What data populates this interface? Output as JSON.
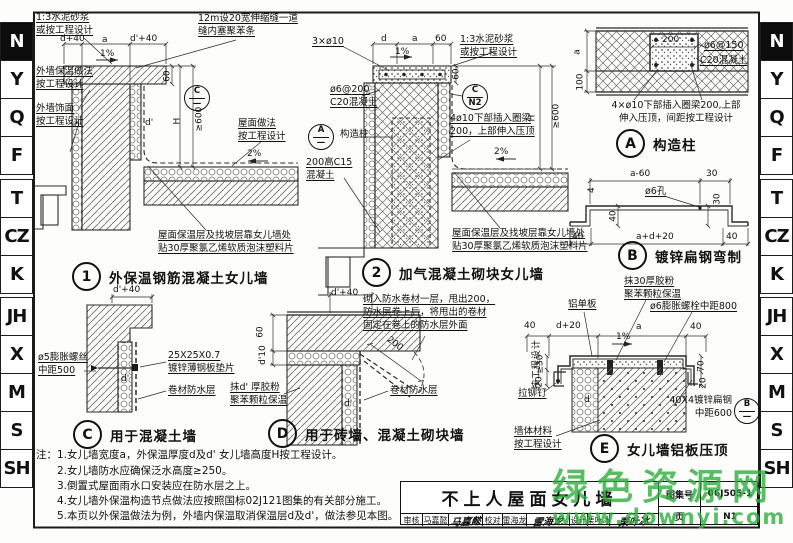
{
  "sidebar": {
    "tabs": [
      "N",
      "Y",
      "Q",
      "F",
      "T",
      "CZ",
      "K",
      "JH",
      "X",
      "M",
      "S",
      "SH"
    ]
  },
  "details": {
    "d1": {
      "num": "1",
      "caption": "外保温钢筋混凝土女儿墙",
      "ref_top": "C",
      "ref_bottom": "—",
      "mortar": "1:3水泥砂浆\n或按工程设计",
      "joint": "12m设20宽伸缩缝一道\n缝内塞聚苯条",
      "wall_insul": "外墙保温做法\n按工程设计",
      "wall_finish": "外墙饰面\n按工程设计",
      "roof": "屋面做法\n按工程设计",
      "foam": "屋面保温层及找坡层靠女儿墙处\n贴30厚聚氯乙烯软质泡沫塑料片",
      "dims": {
        "top_l": "d+40",
        "top_m": "a",
        "top_r": "d'+40",
        "coping_h": "60",
        "h": "H",
        "min_h": "≥600",
        "d": "d",
        "d2": "d'",
        "slope_top": "1%",
        "slope_roof": "2%"
      }
    },
    "d2": {
      "num": "2",
      "caption": "加气混凝土砌块女儿墙",
      "ref_top": "C",
      "ref_bottom": "N2",
      "col_ref_top": "A",
      "col_ref_bottom": "—",
      "rebar": "3×ø10",
      "mesh": "ø6@200\nC20混凝土",
      "col_label": "构造柱",
      "c15": "200高C15\n混凝土",
      "mortar": "1:3水泥砂浆\n或按工程设计",
      "anchor": "4ø10下部插入圈梁\n200，上部伸入压顶",
      "foam": "屋面保温层及找坡层靠女儿墙处\n贴30厚聚氯乙烯软质泡沫塑料片",
      "dims": {
        "top_l": "d",
        "top_m": "a",
        "top_r": "60",
        "coping_h": "60",
        "h": "H",
        "min_h": "≥600",
        "slope_top": "1%",
        "slope_roof": "2%"
      }
    },
    "da": {
      "letter": "A",
      "caption": "构造柱",
      "mesh": "ø6@150",
      "conc": "C20混凝土",
      "note": "4×ø10下部插入圈梁200,上部\n伸入压顶，间距按工程设计",
      "dims": {
        "w": "200",
        "a": "a",
        "h": "100"
      }
    },
    "db": {
      "letter": "B",
      "caption": "镀锌扁钢弯制",
      "hole": "ø6孔",
      "dims": {
        "top_l": "a-60",
        "top_r": "30",
        "bot_l": "40",
        "bot_m": "a+d+20",
        "bot_r": "40",
        "v_l": "40",
        "v_r": "30",
        "t": "4"
      }
    },
    "dc": {
      "letter": "C",
      "caption": "用于混凝土墙",
      "bolt": "ø5膨胀螺丝\n中距500",
      "shim": "25X25X0.7\n镀锌薄钢板垫片",
      "membrane": "卷材防水层",
      "dims": {
        "top": "d'+40",
        "d": "d'"
      }
    },
    "dd": {
      "letter": "D",
      "caption": "用于砖墙、混凝土砌块墙",
      "note": "砌入防水卷材一层，甩出200，\n防水层卷上后，将甩出的卷材\n固定在卷上的防水层外面",
      "membrane": "卷材防水层",
      "plaster": "抹d' 厚胶粉\n聚苯颗粒保温",
      "dims": {
        "top": "d'+40",
        "flap": "200",
        "v1": "60",
        "v2": "d'10",
        "d": "d'"
      }
    },
    "de": {
      "letter": "E",
      "caption": "女儿墙铝板压顶",
      "ref_b_top": "B",
      "ref_b_bottom": "—",
      "alum": "铝单板",
      "plaster": "抹30厚胶粉\n聚苯颗粒保温",
      "bolt": "ø6膨胀螺栓中距800",
      "rivet": "拉铆钉",
      "wall_mat": "墙体材料\n按工程设计",
      "flat": "40X4镀锌扁钢\n中距600",
      "vtext": "按工程设计",
      "dims": {
        "l1": "40",
        "l2": "d+20",
        "a": "a",
        "r1": "40",
        "slope": "1%",
        "v1": "≥30",
        "v2": "20",
        "v3": "70",
        "v4": "20",
        "d": "d"
      }
    }
  },
  "notes": {
    "prefix": "注：",
    "items": [
      "1.女儿墙宽度a，外保温厚度d及d' 女儿墙高度H按工程设计。",
      "2.女儿墙防水应确保泛水高度≥250。",
      "3.倒置式屋面雨水口安装应在防水层之上。",
      "4.女儿墙外保温构造节点做法应按照国标02J121图集的有关部分施工。",
      "5.本页以外保温做法为例，外墙内保温取消保温层d及d'，做法参见本图。"
    ]
  },
  "titleblock": {
    "title": "不上人屋面女儿墙",
    "atlas_label": "图集号",
    "atlas_no": "06J505-1",
    "page_label": "页",
    "page_no": "N1",
    "review_label": "审核",
    "review_name": "马嘉懿",
    "review_sig": "马嘉懿",
    "check_label": "校对",
    "check_name": "雷海龙",
    "check_sig": "雷海龙",
    "design_label": "设计",
    "design_name": "栗叶冰",
    "design_sig": "栗叶冰"
  },
  "watermark": {
    "line1": "绿色资源网",
    "line2": "www.downyi.com",
    "color": "#2fae3e"
  }
}
